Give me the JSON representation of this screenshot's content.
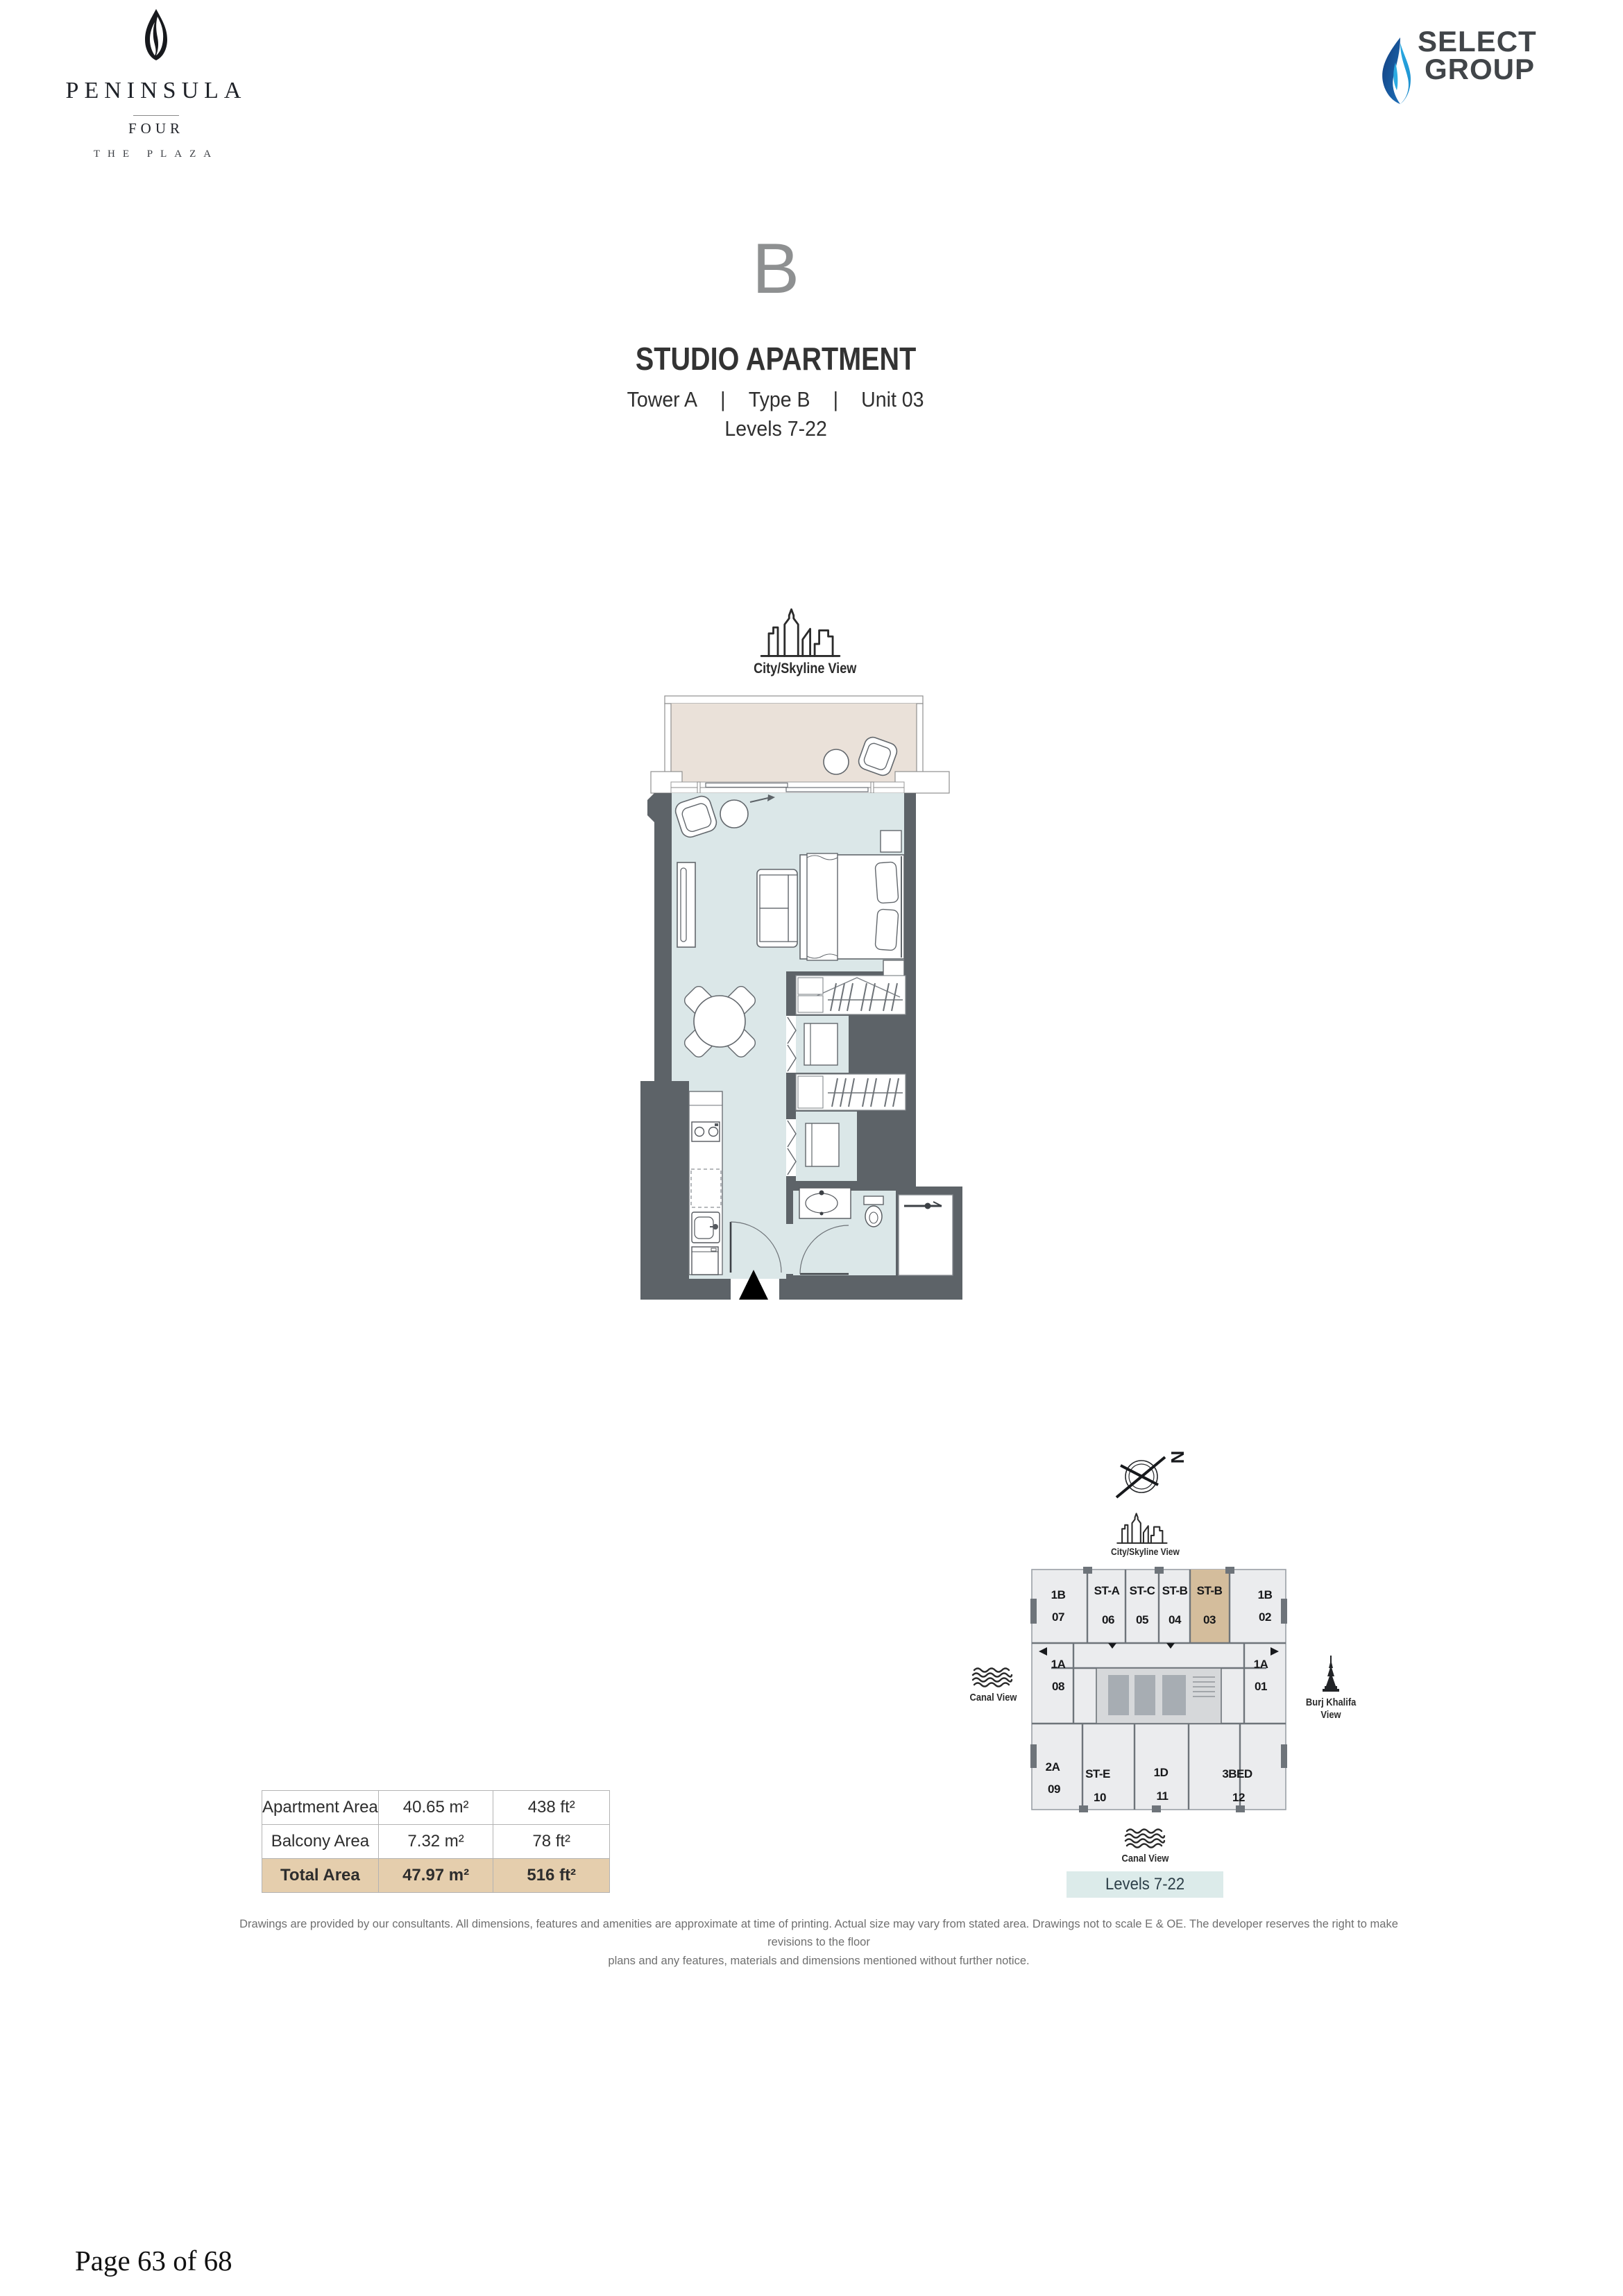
{
  "brand": {
    "line1": "PENINSULA",
    "line2": "FOUR",
    "line3": "THE PLAZA"
  },
  "developer": {
    "line1": "SELECT",
    "line2": "GROUP",
    "flame_blue_dark": "#1d5fa8",
    "flame_blue_light": "#2babe2"
  },
  "unit": {
    "letter": "B",
    "title": "STUDIO APARTMENT",
    "tower": "Tower A",
    "separator": "|",
    "type": "Type B",
    "number": "Unit 03",
    "levels": "Levels 7-22"
  },
  "views": {
    "city": "City/Skyline View",
    "canal": "Canal View",
    "burj_line1": "Burj Khalifa",
    "burj_line2": "View",
    "compass_north": "N"
  },
  "areas": {
    "rows": [
      {
        "label": "Apartment Area",
        "metric": "40.65 m²",
        "imperial": "438 ft²"
      },
      {
        "label": "Balcony Area",
        "metric": "7.32 m²",
        "imperial": "78 ft²"
      },
      {
        "label": "Total Area",
        "metric": "47.97 m²",
        "imperial": "516 ft²"
      }
    ]
  },
  "keyplan": {
    "levels_badge": "Levels 7-22",
    "highlight_color": "#d4bd9c",
    "units": [
      {
        "type": "1B",
        "num": "07"
      },
      {
        "type": "ST-A",
        "num": "06"
      },
      {
        "type": "ST-C",
        "num": "05"
      },
      {
        "type": "ST-B",
        "num": "04"
      },
      {
        "type": "ST-B",
        "num": "03",
        "highlight": true
      },
      {
        "type": "1B",
        "num": "02"
      },
      {
        "type": "1A",
        "num": "08"
      },
      {
        "type": "1A",
        "num": "01"
      },
      {
        "type": "2A",
        "num": "09"
      },
      {
        "type": "ST-E",
        "num": "10"
      },
      {
        "type": "1D",
        "num": "11"
      },
      {
        "type": "3BED",
        "num": "12"
      }
    ]
  },
  "colors": {
    "wall": "#5d6368",
    "room_fill": "#dbe7e8",
    "balcony_fill": "#eae1d9",
    "keyplan_bg": "#ebecee",
    "total_row_bg": "#e5cead",
    "levels_badge_bg": "#dcebea"
  },
  "disclaimer": {
    "line1": "Drawings are provided by our consultants. All dimensions, features and amenities are approximate at time of printing.  Actual size may vary from stated area. Drawings not to scale E & OE. The developer reserves the right to make revisions to the floor",
    "line2": "plans and any features, materials and dimensions mentioned without further notice."
  },
  "footer": {
    "page": "Page 63 of 68"
  }
}
